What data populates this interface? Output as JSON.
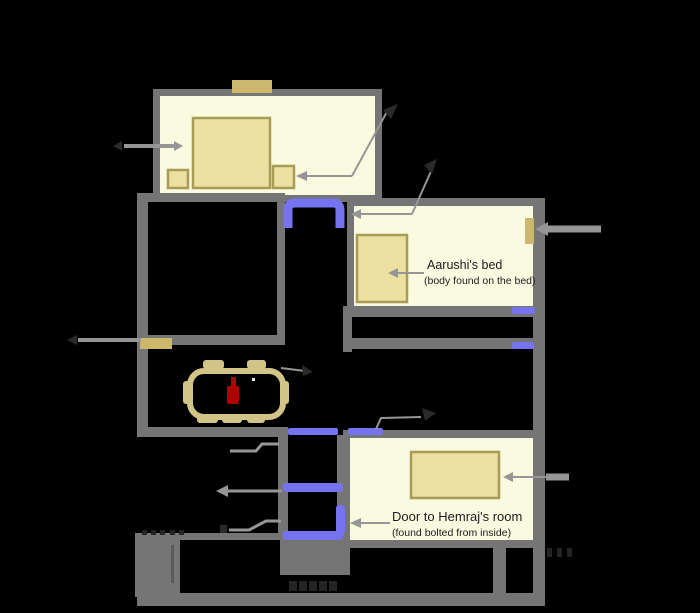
{
  "diagram": {
    "type": "floor-plan",
    "labels": {
      "aarushi_bed": "Aarushi's bed",
      "aarushi_bed_note": "(body found on the bed)",
      "hemraj_door": "Door to Hemraj's room",
      "hemraj_door_note": "(found bolted from inside)"
    },
    "colors": {
      "background": "#000000",
      "wall": "#757575",
      "wall_dark": "#5a5a5a",
      "room_fill": "#fafae1",
      "furniture_fill": "#ebe0a0",
      "furniture_border": "#a89b55",
      "fixture": "#ccb86d",
      "table_outline": "#d2c387",
      "door": "#7673f0",
      "bottle": "#b00000",
      "arrow": "#969696",
      "arrow_dark": "#2a2a2a",
      "text": "#1c1c1c",
      "mark": "#242424",
      "speck": "#e8e8e8"
    }
  }
}
